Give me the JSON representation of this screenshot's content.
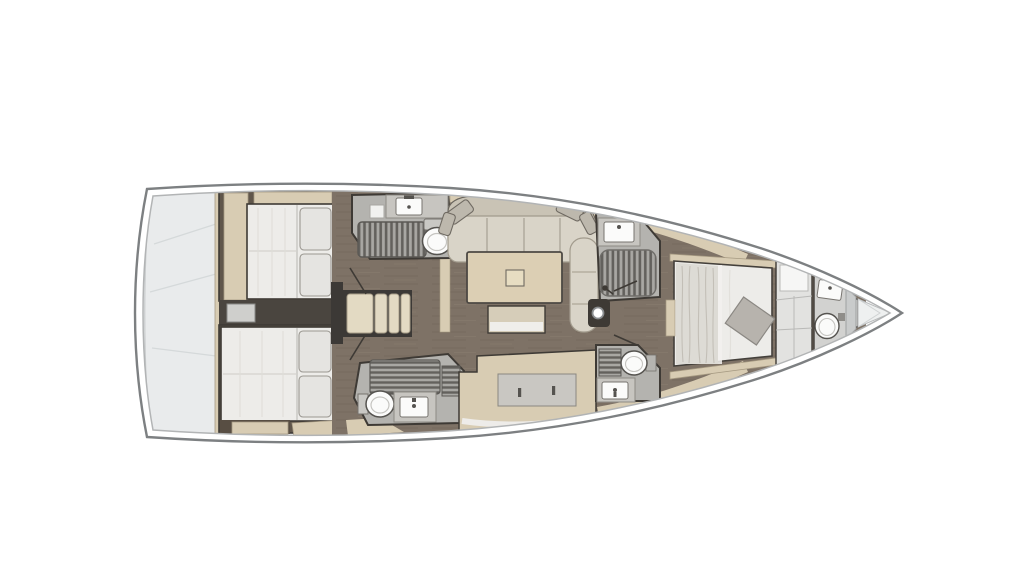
{
  "diagram": {
    "type": "yacht-interior-floor-plan",
    "view": "top-down deck plan",
    "orientation": {
      "bow": "right",
      "stern": "left"
    },
    "vessel": {
      "hull": "sailing monohull",
      "cabins": 3,
      "heads": 4,
      "mast": "single mast on centerline forward of salon"
    },
    "rooms": [
      {
        "id": "swim-platform",
        "label": "Stern transom locker / swim platform"
      },
      {
        "id": "aft-cabin-port",
        "label": "Aft double cabin (top)",
        "fixtures": [
          "double berth",
          "two pillows",
          "wardrobe",
          "shelf"
        ]
      },
      {
        "id": "aft-cabin-starboard",
        "label": "Aft double cabin (bottom)",
        "fixtures": [
          "double berth",
          "two pillows",
          "shelf"
        ]
      },
      {
        "id": "companionway",
        "label": "Companionway steps",
        "steps": 4
      },
      {
        "id": "aft-head-port",
        "label": "Aft head with shower (top)",
        "fixtures": [
          "toilet",
          "washbasin",
          "shower grate"
        ]
      },
      {
        "id": "aft-head-starboard",
        "label": "Aft head with shower (bottom)",
        "fixtures": [
          "toilet",
          "washbasin",
          "shower grate"
        ]
      },
      {
        "id": "salon",
        "label": "Salon",
        "fixtures": [
          "U-shaped sofa",
          "four throw pillows",
          "dining table",
          "bench seat"
        ]
      },
      {
        "id": "galley",
        "label": "Galley counter",
        "fixtures": [
          "worktop",
          "locker handles"
        ]
      },
      {
        "id": "fwd-shower",
        "label": "Forward shower room (top)",
        "fixtures": [
          "washbasin",
          "shower grate",
          "mixer"
        ]
      },
      {
        "id": "fwd-head",
        "label": "Forward head (bottom)",
        "fixtures": [
          "toilet",
          "washbasin",
          "shower grate"
        ]
      },
      {
        "id": "owner-cabin",
        "label": "Forward owner cabin",
        "fixtures": [
          "island double berth",
          "duvet",
          "grey throw blanket",
          "wardrobe"
        ]
      },
      {
        "id": "bow-head",
        "label": "Bow washroom",
        "fixtures": [
          "toilet",
          "washbasin"
        ]
      },
      {
        "id": "forepeak",
        "label": "Anchor locker"
      },
      {
        "id": "mast",
        "label": "Mast foot"
      }
    ],
    "palette": {
      "paper": "#ffffff",
      "hull_line": "#7d8082",
      "hull_inner": "#b2b4b5",
      "transom": "#e9ebec",
      "transom_seam": "#d5d9da",
      "wall": "#3e3a35",
      "cabin_floor": "#60564b",
      "wood": "#7e7266",
      "beige": "#d8ccb3",
      "beige_edge": "#a69a82",
      "steps": "#e3dac3",
      "counter": "#c7c5c0",
      "counter_edge": "#8e8b85",
      "grate_bg": "#a8a7a3",
      "grate_slat": "#63615d",
      "shower_floor": "#b4b3af",
      "fixture_white": "#fbfbfa",
      "fixture_line": "#77746f",
      "mattress": "#edece9",
      "mattress_shade": "#dddbd5",
      "pillow": "#e5e4e1",
      "sofa": "#d9d4c8",
      "sofa_back": "#c9c3b5",
      "sofa_line": "#a29b8d",
      "table": "#dccfb4",
      "table_inset": "#e7ddc2",
      "bench_white": "#efeeeb",
      "throw": "#b7b3ad",
      "wardrobe": "#e2e2e0",
      "bow_floor": "#d2d2d0",
      "forepeak": "#eef0f0"
    }
  }
}
